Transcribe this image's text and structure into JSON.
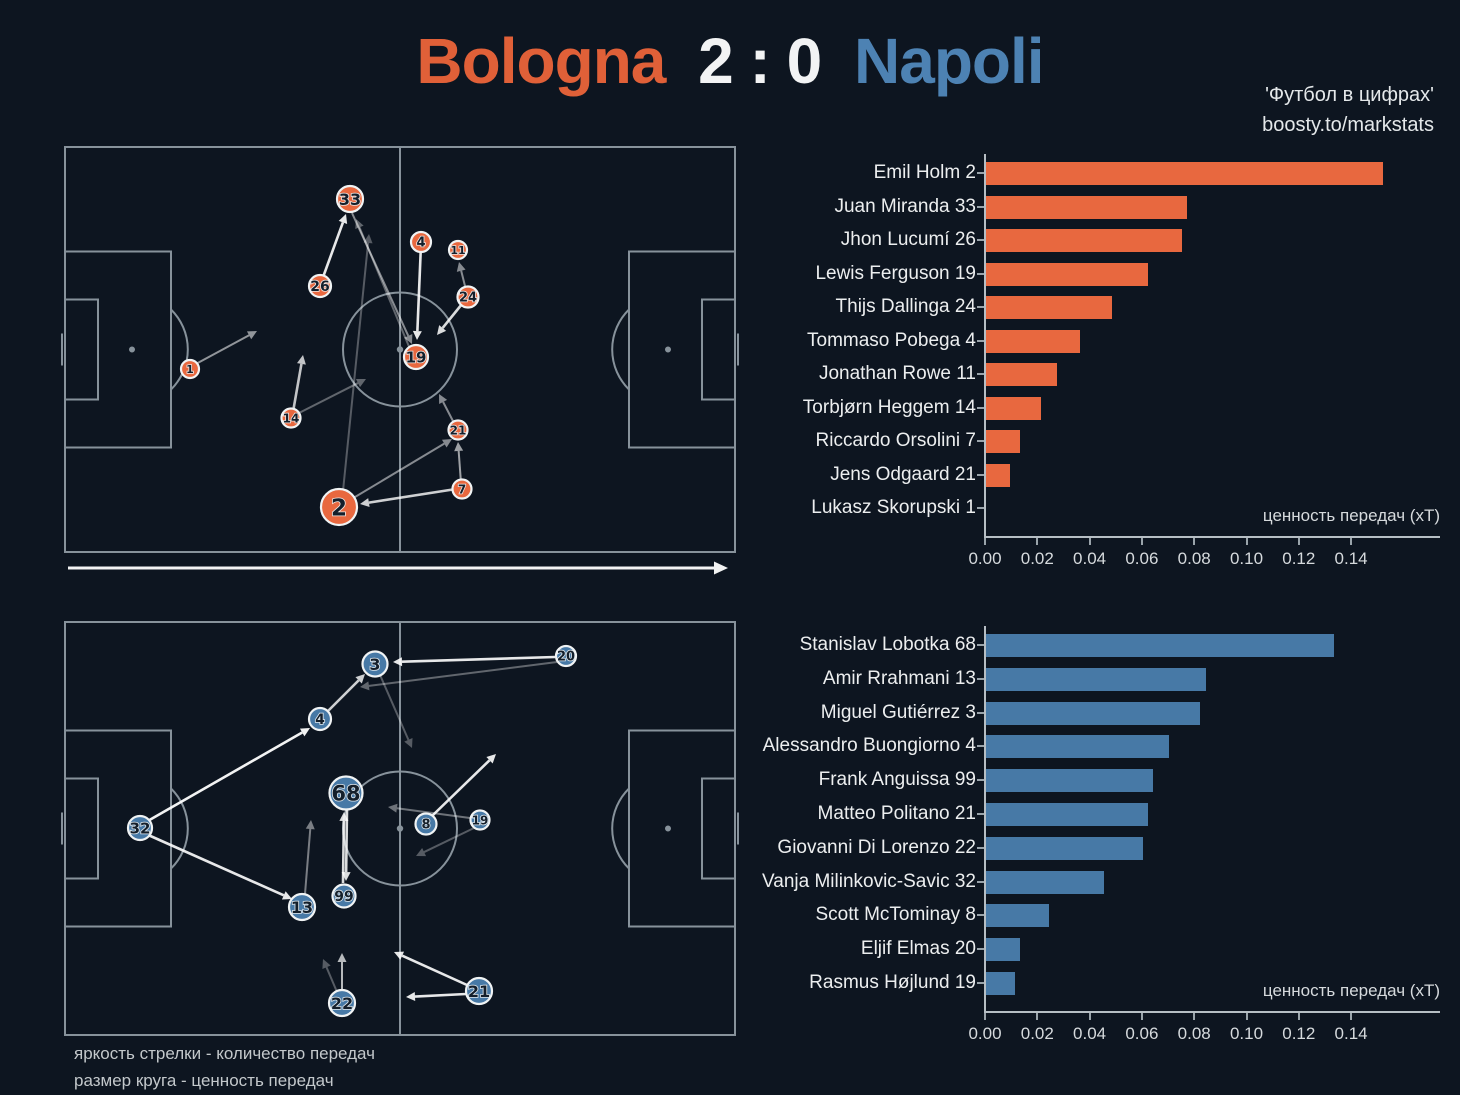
{
  "scoreline": {
    "home": "Bologna",
    "score": "2 : 0",
    "away": "Napoli"
  },
  "watermark": {
    "line1": "'Футбол в цифрах'",
    "line2": "boosty.to/markstats"
  },
  "legend": {
    "line1": "яркость стрелки - количество передач",
    "line2": "размер круга - ценность передач"
  },
  "colors": {
    "background": "#0d1520",
    "bologna": "#e8683f",
    "napoli": "#4779a6",
    "title_home": "#e06038",
    "title_score": "#f2f3f4",
    "title_away": "#4d82b3",
    "pitch_line": "#8e99a2",
    "arrow": "#ffffff",
    "node_ring": "#f0f3f4",
    "node_number": "#141f2b"
  },
  "chart_data": [
    {
      "type": "bar",
      "orientation": "horizontal",
      "team": "Bologna",
      "color": "#e8683f",
      "categories": [
        "Emil Holm 2",
        "Juan Miranda 33",
        "Jhon Lucumí 26",
        "Lewis Ferguson 19",
        "Thijs Dallinga 24",
        "Tommaso Pobega 4",
        "Jonathan Rowe 11",
        "Torbjørn Heggem 14",
        "Riccardo Orsolini 7",
        "Jens Odgaard 21",
        "Lukasz Skorupski 1"
      ],
      "values": [
        0.152,
        0.077,
        0.075,
        0.062,
        0.048,
        0.036,
        0.027,
        0.021,
        0.013,
        0.009,
        0.0
      ],
      "xlabel": "ценность передач (xT)",
      "xticks": [
        0,
        0.02,
        0.04,
        0.06,
        0.08,
        0.1,
        0.12,
        0.14
      ],
      "xlim": [
        0,
        0.16
      ],
      "grid": false,
      "legend_position": "none"
    },
    {
      "type": "bar",
      "orientation": "horizontal",
      "team": "Napoli",
      "color": "#4779a6",
      "categories": [
        "Stanislav Lobotka 68",
        "Amir Rrahmani 13",
        "Miguel Gutiérrez 3",
        "Alessandro Buongiorno 4",
        "Frank Anguissa 99",
        "Matteo Politano 21",
        "Giovanni Di Lorenzo 22",
        "Vanja Milinkovic-Savic 32",
        "Scott McTominay 8",
        "Eljif Elmas 20",
        "Rasmus Højlund 19"
      ],
      "values": [
        0.133,
        0.084,
        0.082,
        0.07,
        0.064,
        0.062,
        0.06,
        0.045,
        0.024,
        0.013,
        0.011
      ],
      "xlabel": "ценность передач (xT)",
      "xticks": [
        0,
        0.02,
        0.04,
        0.06,
        0.08,
        0.1,
        0.12,
        0.14
      ],
      "xlim": [
        0,
        0.16
      ],
      "grid": false,
      "legend_position": "none"
    }
  ],
  "pass_networks": {
    "bologna": {
      "team": "Bologna",
      "color": "#e8683f",
      "nodes": [
        {
          "label": "33",
          "x": 290,
          "y": 57,
          "r": 13
        },
        {
          "label": "4",
          "x": 361,
          "y": 100,
          "r": 10
        },
        {
          "label": "11",
          "x": 398,
          "y": 108,
          "r": 9
        },
        {
          "label": "26",
          "x": 260,
          "y": 144,
          "r": 11
        },
        {
          "label": "24",
          "x": 408,
          "y": 155,
          "r": 10.5
        },
        {
          "label": "19",
          "x": 356,
          "y": 215,
          "r": 12
        },
        {
          "label": "1",
          "x": 130,
          "y": 227,
          "r": 9
        },
        {
          "label": "14",
          "x": 231,
          "y": 276,
          "r": 9.5
        },
        {
          "label": "21",
          "x": 398,
          "y": 288,
          "r": 9.5
        },
        {
          "label": "7",
          "x": 402,
          "y": 347,
          "r": 9.5
        },
        {
          "label": "2",
          "x": 279,
          "y": 365,
          "r": 18
        }
      ],
      "arrows": [
        {
          "x1": 262,
          "y1": 138,
          "x2": 286,
          "y2": 72,
          "o": 0.9
        },
        {
          "x1": 292,
          "y1": 71,
          "x2": 352,
          "y2": 202,
          "o": 0.5
        },
        {
          "x1": 361,
          "y1": 102,
          "x2": 357,
          "y2": 198,
          "o": 0.9
        },
        {
          "x1": 406,
          "y1": 148,
          "x2": 399,
          "y2": 120,
          "o": 0.5
        },
        {
          "x1": 402,
          "y1": 162,
          "x2": 377,
          "y2": 193,
          "o": 0.85
        },
        {
          "x1": 134,
          "y1": 223,
          "x2": 197,
          "y2": 189,
          "o": 0.55
        },
        {
          "x1": 233,
          "y1": 270,
          "x2": 243,
          "y2": 213,
          "o": 0.75
        },
        {
          "x1": 237,
          "y1": 272,
          "x2": 306,
          "y2": 237,
          "o": 0.35
        },
        {
          "x1": 290,
          "y1": 358,
          "x2": 392,
          "y2": 297,
          "o": 0.5
        },
        {
          "x1": 401,
          "y1": 341,
          "x2": 398,
          "y2": 300,
          "o": 0.6
        },
        {
          "x1": 396,
          "y1": 347,
          "x2": 300,
          "y2": 362,
          "o": 0.8
        },
        {
          "x1": 394,
          "y1": 281,
          "x2": 379,
          "y2": 252,
          "o": 0.5
        },
        {
          "x1": 283,
          "y1": 349,
          "x2": 309,
          "y2": 92,
          "o": 0.3
        },
        {
          "x1": 350,
          "y1": 207,
          "x2": 296,
          "y2": 77,
          "o": 0.35
        }
      ],
      "direction_arrow": {
        "x1": 8,
        "y1": 426,
        "x2": 668,
        "y2": 426,
        "o": 0.95,
        "big": true
      }
    },
    "napoli": {
      "team": "Napoli",
      "color": "#4779a6",
      "nodes": [
        {
          "label": "3",
          "x": 315,
          "y": 46,
          "r": 12.5
        },
        {
          "label": "20",
          "x": 506,
          "y": 38,
          "r": 10
        },
        {
          "label": "4",
          "x": 260,
          "y": 101,
          "r": 11
        },
        {
          "label": "68",
          "x": 286,
          "y": 175,
          "r": 16.5
        },
        {
          "label": "32",
          "x": 80,
          "y": 210,
          "r": 12
        },
        {
          "label": "8",
          "x": 366,
          "y": 206,
          "r": 10.5
        },
        {
          "label": "19",
          "x": 420,
          "y": 202,
          "r": 9.5
        },
        {
          "label": "13",
          "x": 242,
          "y": 289,
          "r": 13
        },
        {
          "label": "99",
          "x": 284,
          "y": 278,
          "r": 11.5
        },
        {
          "label": "22",
          "x": 282,
          "y": 385,
          "r": 13
        },
        {
          "label": "21",
          "x": 419,
          "y": 373,
          "r": 13
        }
      ],
      "arrows": [
        {
          "x1": 86,
          "y1": 204,
          "x2": 250,
          "y2": 110,
          "o": 0.95
        },
        {
          "x1": 86,
          "y1": 216,
          "x2": 232,
          "y2": 281,
          "o": 0.9
        },
        {
          "x1": 266,
          "y1": 95,
          "x2": 305,
          "y2": 56,
          "o": 0.8
        },
        {
          "x1": 320,
          "y1": 57,
          "x2": 352,
          "y2": 130,
          "o": 0.3
        },
        {
          "x1": 495,
          "y1": 39,
          "x2": 333,
          "y2": 44,
          "o": 0.9
        },
        {
          "x1": 497,
          "y1": 44,
          "x2": 300,
          "y2": 69,
          "o": 0.35
        },
        {
          "x1": 372,
          "y1": 198,
          "x2": 436,
          "y2": 136,
          "o": 0.9
        },
        {
          "x1": 410,
          "y1": 200,
          "x2": 328,
          "y2": 189,
          "o": 0.4
        },
        {
          "x1": 414,
          "y1": 210,
          "x2": 356,
          "y2": 238,
          "o": 0.3
        },
        {
          "x1": 287,
          "y1": 192,
          "x2": 286,
          "y2": 263,
          "o": 0.85
        },
        {
          "x1": 283,
          "y1": 265,
          "x2": 284,
          "y2": 194,
          "o": 0.85
        },
        {
          "x1": 245,
          "y1": 276,
          "x2": 251,
          "y2": 202,
          "o": 0.45
        },
        {
          "x1": 282,
          "y1": 372,
          "x2": 282,
          "y2": 335,
          "o": 0.7
        },
        {
          "x1": 277,
          "y1": 374,
          "x2": 263,
          "y2": 341,
          "o": 0.3
        },
        {
          "x1": 407,
          "y1": 367,
          "x2": 334,
          "y2": 334,
          "o": 0.9
        },
        {
          "x1": 406,
          "y1": 376,
          "x2": 346,
          "y2": 379,
          "o": 0.9
        }
      ]
    }
  }
}
